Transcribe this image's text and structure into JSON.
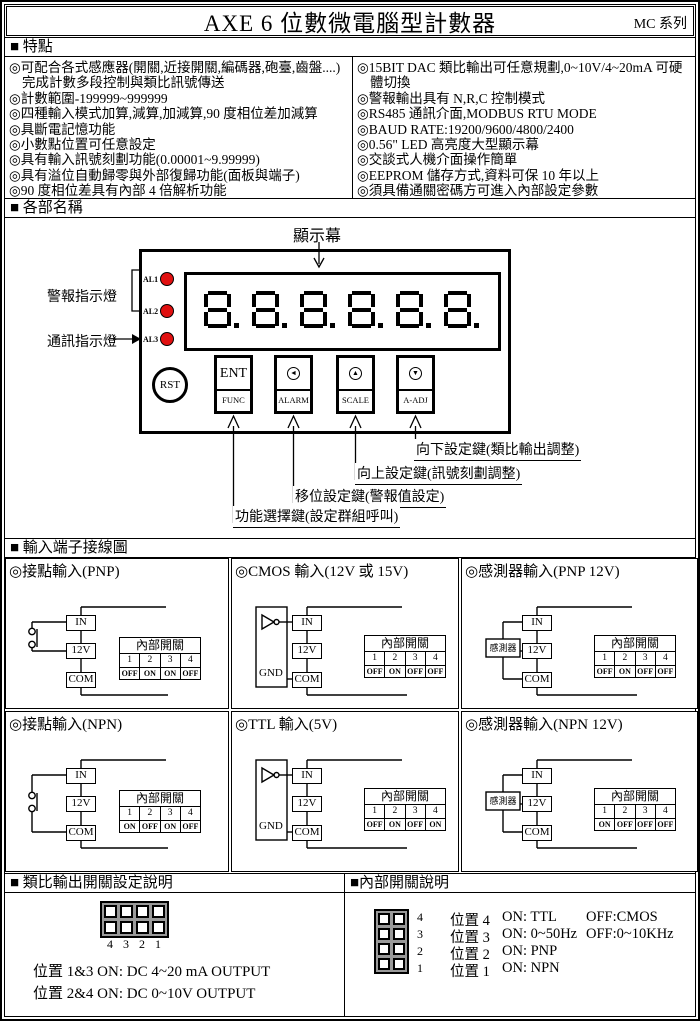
{
  "page": {
    "title": "AXE 6 位數微電腦型計數器",
    "series": "MC 系列"
  },
  "colors": {
    "led_red": "#e01010",
    "jumper_gray": "#9a9a9a"
  },
  "features": {
    "header": "■ 特點",
    "left": [
      "◎可配合各式感應器(開關,近接開關,編碼器,砲臺,齒盤....)  完成計數多段控制與類比訊號傳送",
      "◎計數範圍-199999~999999",
      "◎四種輸入模式加算,減算,加減算,90 度相位差加減算",
      "◎具斷電記憶功能",
      "◎小數點位置可任意設定",
      "◎具有輸入訊號刻劃功能(0.00001~9.99999)",
      "◎具有溢位自動歸零與外部復歸功能(面板與端子)",
      "◎90 度相位差具有內部 4 倍解析功能"
    ],
    "right": [
      "◎15BIT DAC 類比輸出可任意規劃,0~10V/4~20mA 可硬體切換",
      "◎警報輸出具有 N,R,C 控制模式",
      "◎RS485 通訊介面,MODBUS RTU MODE",
      "◎BAUD RATE:19200/9600/4800/2400",
      "◎0.56\" LED 高亮度大型顯示幕",
      "◎交談式人機介面操作簡單",
      "◎EEPROM 儲存方式,資料可保 10 年以上",
      "◎須具備通關密碼方可進入內部設定參數"
    ]
  },
  "device": {
    "section_title": "■ 各部名稱",
    "display_label": "顯示幕",
    "alarm_label": "警報指示燈",
    "comm_label": "通訊指示燈",
    "leds": [
      "AL1",
      "AL2",
      "AL3"
    ],
    "reset_button": "RST",
    "buttons": [
      {
        "top": "ENT",
        "bottom": "FUNC"
      },
      {
        "icon_glyph": "◄",
        "bottom": "ALARM"
      },
      {
        "icon_glyph": "▲",
        "bottom": "SCALE"
      },
      {
        "icon_glyph": "▼",
        "bottom": "A-ADJ"
      }
    ],
    "key_labels": [
      "向下設定鍵(類比輸出調整)",
      "向上設定鍵(訊號刻劃調整)",
      "移位設定鍵(警報值設定)",
      "功能選擇鍵(設定群組呼叫)"
    ]
  },
  "wiring": {
    "section_title": "■ 輸入端子接線圖",
    "terminals": {
      "in": "IN",
      "v12": "12V",
      "com": "COM"
    },
    "table_header": "內部開關",
    "table_cols": [
      "1",
      "2",
      "3",
      "4"
    ],
    "cells": [
      {
        "title": "◎接點輸入(PNP)",
        "values": [
          "OFF",
          "ON",
          "ON",
          "OFF"
        ]
      },
      {
        "title": "◎CMOS 輸入(12V 或 15V)",
        "source_label": "GND",
        "values": [
          "OFF",
          "ON",
          "OFF",
          "OFF"
        ]
      },
      {
        "title": "◎感測器輸入(PNP 12V)",
        "source_label": "感測器",
        "values": [
          "OFF",
          "ON",
          "OFF",
          "OFF"
        ]
      },
      {
        "title": "◎接點輸入(NPN)",
        "values": [
          "ON",
          "OFF",
          "ON",
          "OFF"
        ]
      },
      {
        "title": "◎TTL 輸入(5V)",
        "source_label": "GND",
        "values": [
          "OFF",
          "ON",
          "OFF",
          "ON"
        ]
      },
      {
        "title": "◎感測器輸入(NPN 12V)",
        "source_label": "感測器",
        "values": [
          "ON",
          "OFF",
          "OFF",
          "OFF"
        ]
      }
    ]
  },
  "analog": {
    "title": "■ 類比輸出開關設定說明",
    "pin_numbers": [
      "4",
      "3",
      "2",
      "1"
    ],
    "lines": [
      "位置 1&3 ON: DC 4~20 mA OUTPUT",
      "位置 2&4 ON: DC 0~10V OUTPUT"
    ]
  },
  "internal": {
    "title": "■內部開關說明",
    "rows": [
      {
        "num": "4",
        "label": "位置 4",
        "on": "ON: TTL",
        "off": "OFF:CMOS"
      },
      {
        "num": "3",
        "label": "位置 3",
        "on": "ON: 0~50Hz",
        "off": "OFF:0~10KHz"
      },
      {
        "num": "2",
        "label": "位置 2",
        "on": "ON: PNP",
        "off": ""
      },
      {
        "num": "1",
        "label": "位置 1",
        "on": "ON: NPN",
        "off": ""
      }
    ]
  }
}
